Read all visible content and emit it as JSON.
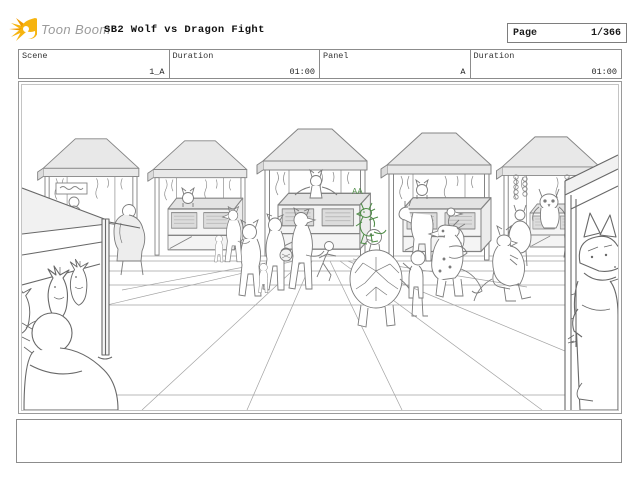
{
  "header": {
    "logo_text": "Toon Boom",
    "logo_icon": "toonboom-starburst-logo",
    "logo_yellow": "#f6b410",
    "logo_orange": "#f09a00",
    "title": "SB2 Wolf vs Dragon Fight",
    "page_label": "Page",
    "page_value": "1/366"
  },
  "panel_info": {
    "cells": [
      {
        "label": "Scene",
        "value": "1_A"
      },
      {
        "label": "Duration",
        "value": "01:00"
      },
      {
        "label": "Panel",
        "value": "A"
      },
      {
        "label": "Duration",
        "value": "01:00"
      }
    ]
  },
  "drawing": {
    "description": "Storyboard rough sketch: outdoor market plaza with five canopy tents and display counters, animal vendors and shoppers (wolves, foxes, a cat, an owl, a horse, a goose), a turtle walking with a child, dragons near the stalls, a small green-sketched dragon annotation, foreground fish stall at left with bald vendor seen from behind, and a large dragon peeking around a stall frame at right.",
    "annotation": "AA",
    "accent_green": "#4e8c46",
    "sketch_gray": "#7b7b7b"
  },
  "caption": {
    "text": ""
  }
}
